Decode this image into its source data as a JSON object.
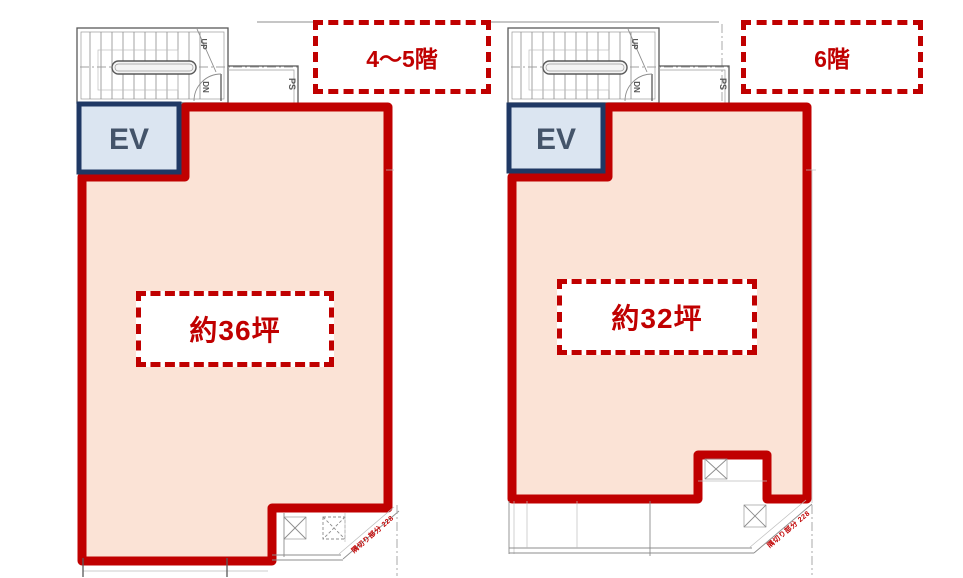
{
  "colors": {
    "outline_red": "#c00000",
    "room_fill": "#fbe3d6",
    "elevator_fill": "#dbe5f1",
    "elevator_border": "#1f3864",
    "annotation_red": "#c00000"
  },
  "left_plan": {
    "floor_label": "4～5階",
    "area_label": "約36坪",
    "ev_label": "EV",
    "corner_note": "隅切り部分 228"
  },
  "right_plan": {
    "floor_label": "6階",
    "area_label": "約32坪",
    "ev_label": "EV",
    "corner_note": "隅切り部分 228"
  },
  "stair": {
    "up_label": "UP",
    "down_label": "DN",
    "pipe_shaft_label": "PS"
  }
}
